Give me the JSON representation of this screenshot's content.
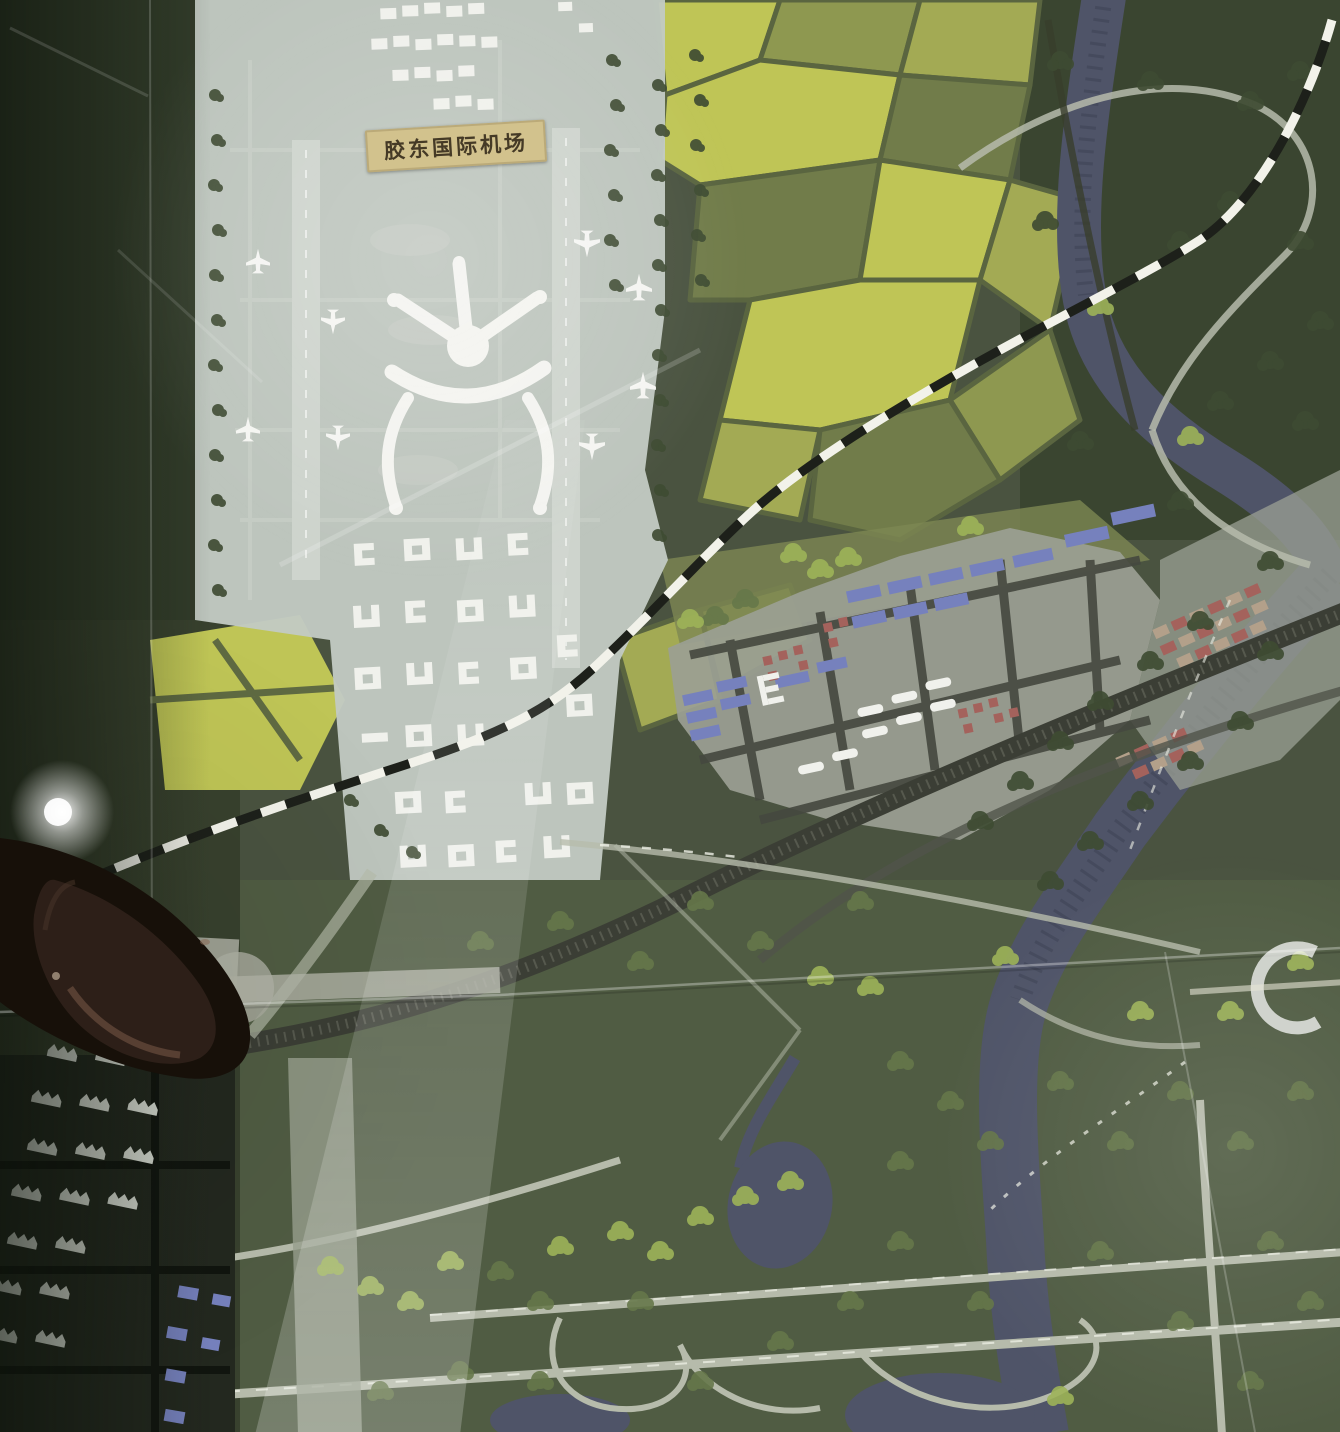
{
  "plaque": {
    "text": "胶东国际机场"
  },
  "colors": {
    "base-green": "#4a5340",
    "dark-green": "#323c2a",
    "forest-green": "#3a4530",
    "park-green": "#505c43",
    "field-bright": "#bfc556",
    "field-mid": "#a3aa54",
    "field-olive": "#8e9850",
    "field-dark": "#717c4a",
    "field-border": "#5a6540",
    "airport-pale": "#c2cac3",
    "runway-pale": "#ced4cd",
    "white-building": "#f0f1ec",
    "roof-blue": "#7681bd",
    "roof-red": "#a4625c",
    "tan-building": "#b3a08a",
    "ground-gray": "#9ba094",
    "road-dark": "#45483f",
    "road-pale": "#b6bbab",
    "water": "#4f5468",
    "water-dark": "#3f4457",
    "tree-dark": "#3f4c33",
    "tree-mid": "#66784a",
    "tree-light": "#9db459",
    "rail-dark": "#3b3e35",
    "plaque-bg": "#d2c28d",
    "plaque-text": "#453a26",
    "shoe-dark": "#171009",
    "shoe-leather": "#2e2119"
  }
}
